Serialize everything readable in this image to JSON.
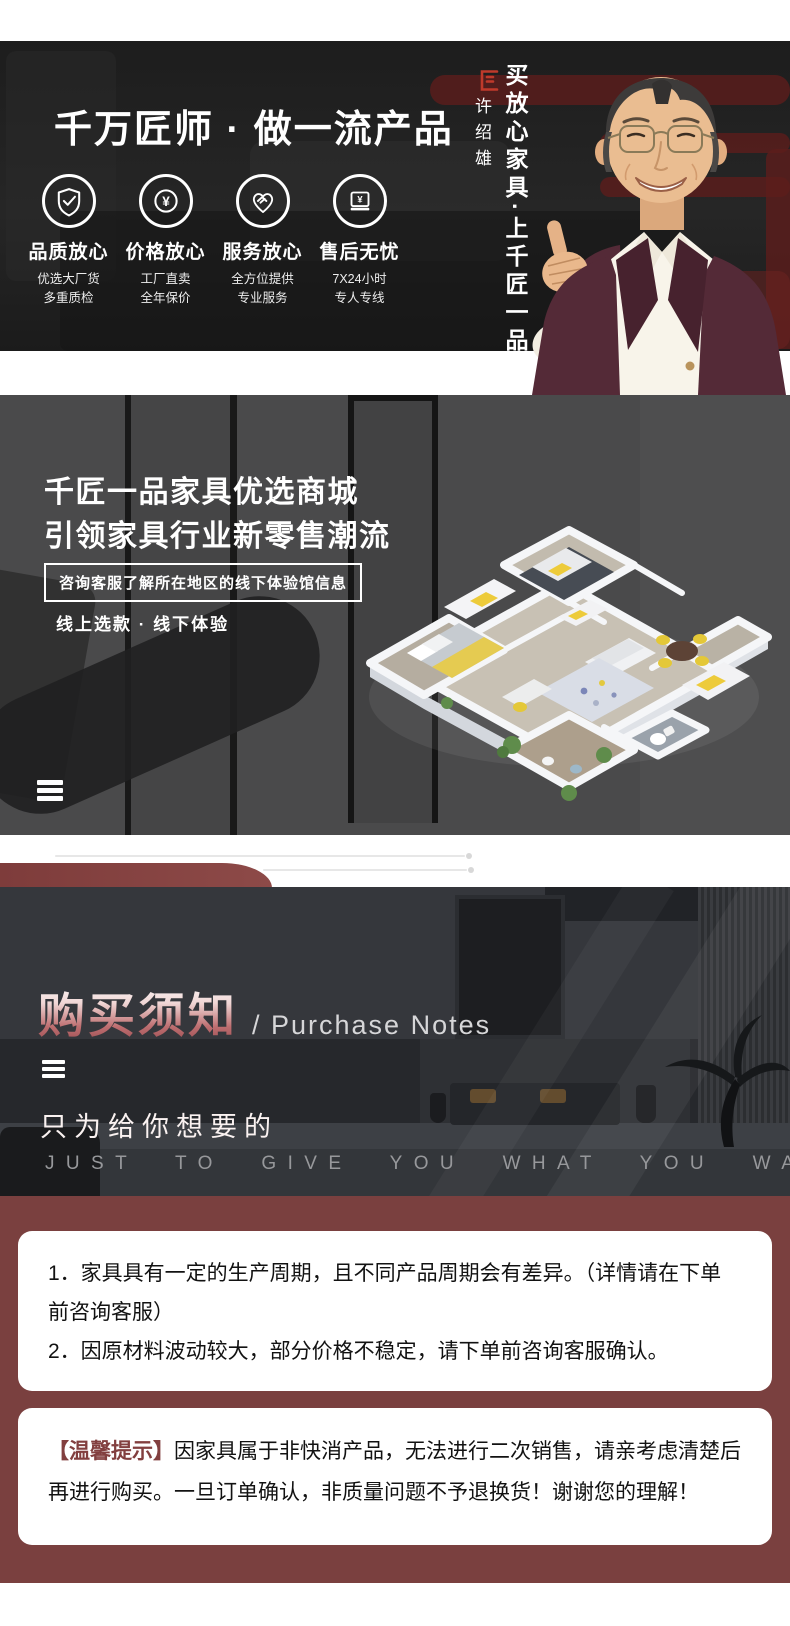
{
  "colors": {
    "hero_bg": "#1d1d1d",
    "mall_bg": "#4a4a4b",
    "notes_bg": "#26282c",
    "maroon": "#7a403f",
    "accent_red": "#bf3a2b",
    "yellow_accent": "#e8c93e"
  },
  "hero": {
    "headline": "千万匠师 · 做一流产品",
    "features": [
      {
        "icon": "shield-check-icon",
        "title": "品质放心",
        "line1": "优选大厂货",
        "line2": "多重质检"
      },
      {
        "icon": "yuan-circle-icon",
        "title": "价格放心",
        "line1": "工厂直卖",
        "line2": "全年保价"
      },
      {
        "icon": "handshake-heart-icon",
        "title": "服务放心",
        "line1": "全方位提供",
        "line2": "专业服务"
      },
      {
        "icon": "warranty-card-icon",
        "title": "售后无忧",
        "line1": "7X24小时",
        "line2": "专人专线"
      }
    ],
    "endorser_name": "许绍雄",
    "slogan_vertical": "买放心家具·上千匠一品"
  },
  "mall": {
    "title_line1": "千匠一品家具优选商城",
    "title_line2": "引领家具行业新零售潮流",
    "notice": "咨询客服了解所在地区的线下体验馆信息",
    "tagline": "线上选款 · 线下体验"
  },
  "purchase_notes": {
    "title_cn": "购买须知",
    "title_en": "/ Purchase Notes",
    "subtitle_cn": "只为给你想要的",
    "subtitle_en": "JUST TO GIVE YOU WHAT YOU WANT"
  },
  "notes": {
    "item1": "1．家具具有一定的生产周期，且不同产品周期会有差异。（详情请在下单前咨询客服）",
    "item2": "2．因原材料波动较大，部分价格不稳定，请下单前咨询客服确认。",
    "tip_label": "【温馨提示】",
    "tip_text": "因家具属于非快消产品，无法进行二次销售，请亲考虑清楚后再进行购买。一旦订单确认，非质量问题不予退换货！谢谢您的理解！"
  }
}
